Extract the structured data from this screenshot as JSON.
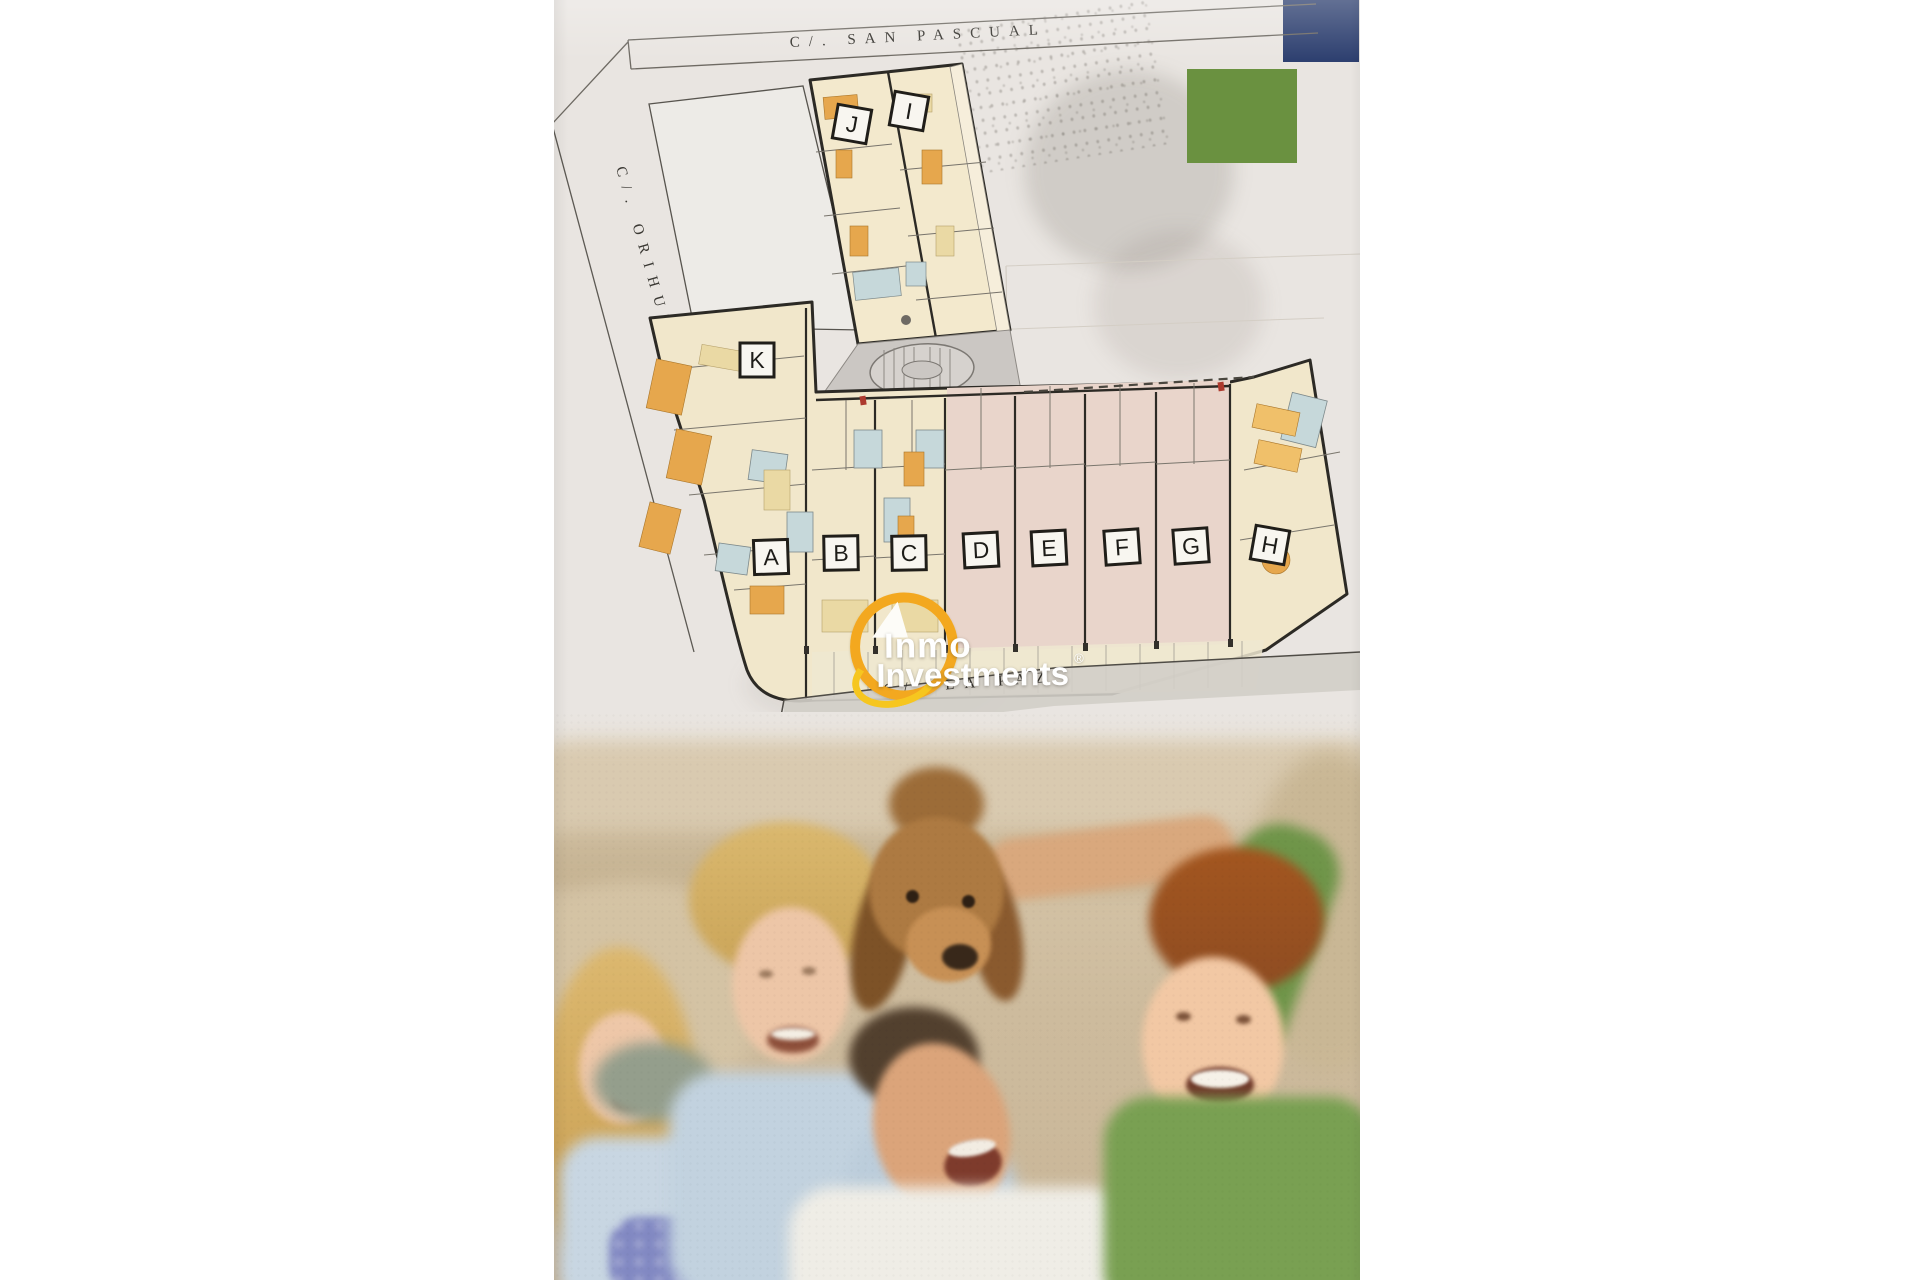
{
  "page": {
    "background_color": "#ffffff"
  },
  "brochure": {
    "paper_color": "#e9e5e1",
    "accents": {
      "blue_square": "#2e4070",
      "green_square": "#6a9140"
    }
  },
  "plan": {
    "streets": {
      "top": "C/.  SAN  PASCUAL",
      "left": "C/.  ORIHUELA",
      "bottom": "C/.  LA  PAZ"
    },
    "units": [
      {
        "label": "A"
      },
      {
        "label": "B"
      },
      {
        "label": "C"
      },
      {
        "label": "D"
      },
      {
        "label": "E"
      },
      {
        "label": "F"
      },
      {
        "label": "G"
      },
      {
        "label": "H"
      },
      {
        "label": "I"
      },
      {
        "label": "J"
      },
      {
        "label": "K"
      }
    ],
    "palette": {
      "room_cream": "#f1e7cb",
      "room_pink": "#e9d5cb",
      "bathroom_blue": "#c6d8da",
      "furniture_orange": "#e6a74d",
      "wall": "#2c2a25",
      "stairs_gray": "#cbc7c3",
      "street_band_gray": "#d2cec8"
    }
  },
  "watermark": {
    "brand_line1": "Inmo",
    "brand_line2": "Investments",
    "registered_mark": "®",
    "ring_color": "#f3a81f",
    "text_color": "#ffffff"
  }
}
